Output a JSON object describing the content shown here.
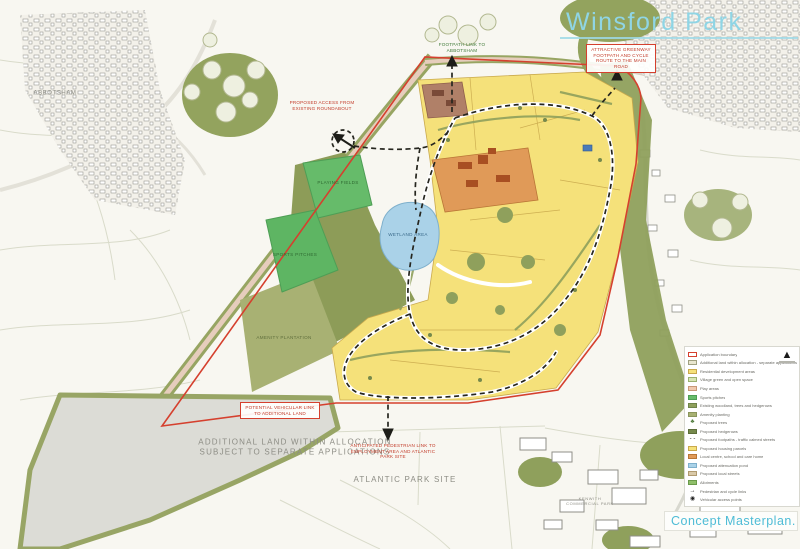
{
  "header": {
    "title": "Winsford Park",
    "plan_label": "Concept Masterplan."
  },
  "colors": {
    "accent_teal": "#4ebcd6",
    "boundary_red": "#d5402e",
    "housing_yellow": "#f5e17a",
    "woodland_olive": "#8fa05c",
    "pond_blue": "#aad2e8",
    "centre_orange": "#e09a58",
    "pitch_green": "#66bb6a",
    "allocation_gray": "#dcdcd6"
  },
  "map_labels": {
    "abbotsham": "ABBOTSHAM",
    "additional_land": "ADDITIONAL LAND WITHIN ALLOCATION\nSUBJECT TO SEPARATE APPLICATIONS",
    "atlantic_park": "ATLANTIC PARK SITE",
    "commercial_park": "KENWITH\nCOMMERCIAL PARK",
    "playing_fields": "PLAYING\nFIELDS",
    "wetland": "WETLAND\nAREA",
    "sports_pitches": "SPORTS\nPITCHES",
    "plantation": "AMENITY\nPLANTATION"
  },
  "annotations": {
    "roundabout_note": "Proposed access from existing roundabout",
    "footpath_note": "Footpath link to Abbotsham",
    "greenway_note": "Attractive greenway footpath and cycle route to the main road",
    "vehicular_note": "Potential vehicular link to additional land",
    "pedestrian_note": "Anticipated pedestrian link to employment area and Atlantic Park site"
  },
  "legend": {
    "items": [
      {
        "label": "Application boundary",
        "swatch": "#ffffff",
        "border": "#d5402e"
      },
      {
        "label": "Additional land within allocation - separate applications",
        "swatch": "#e9e6cf",
        "border": "#a0a080"
      },
      {
        "label": "Residential development areas",
        "swatch": "#f5e17a",
        "border": "#c9a94d"
      },
      {
        "label": "Village green and open space",
        "swatch": "#d8e6b4",
        "border": "#9ab070"
      },
      {
        "label": "Play areas",
        "swatch": "#f0c9ae",
        "border": "#c89878"
      },
      {
        "label": "Sports pitches",
        "swatch": "#66bb6a",
        "border": "#4e9e55"
      },
      {
        "label": "Existing woodland, trees and hedgerows",
        "swatch": "#8fa05c",
        "border": "#6f844a"
      },
      {
        "label": "Amenity planting",
        "swatch": "#a8b173",
        "border": "#8a955c"
      },
      {
        "label": "Proposed trees",
        "icon": "♣",
        "color": "#4e7a3a"
      },
      {
        "label": "Proposed hedgerows",
        "swatch": "#76894c",
        "border": "#5d6e3a"
      },
      {
        "label": "Proposed footpaths - traffic calmed streets",
        "icon": "- -",
        "color": "#222222"
      },
      {
        "label": "Proposed housing parcels",
        "swatch": "#f5e17a",
        "border": "#c9a94d"
      },
      {
        "label": "Local centre, school and care home",
        "swatch": "#e09a58",
        "border": "#b97636"
      },
      {
        "label": "Proposed attenuation pond",
        "swatch": "#aad2e8",
        "border": "#7fb0cc"
      },
      {
        "label": "Proposed local streets",
        "swatch": "#d9c9a8",
        "border": "#b09a70"
      },
      {
        "label": "Allotments",
        "swatch": "#8fbf6a",
        "border": "#6a9a4a"
      },
      {
        "label": "Pedestrian and cycle links",
        "icon": "→",
        "color": "#222222"
      },
      {
        "label": "Vehicular access points",
        "icon": "◉",
        "color": "#222222"
      }
    ]
  }
}
